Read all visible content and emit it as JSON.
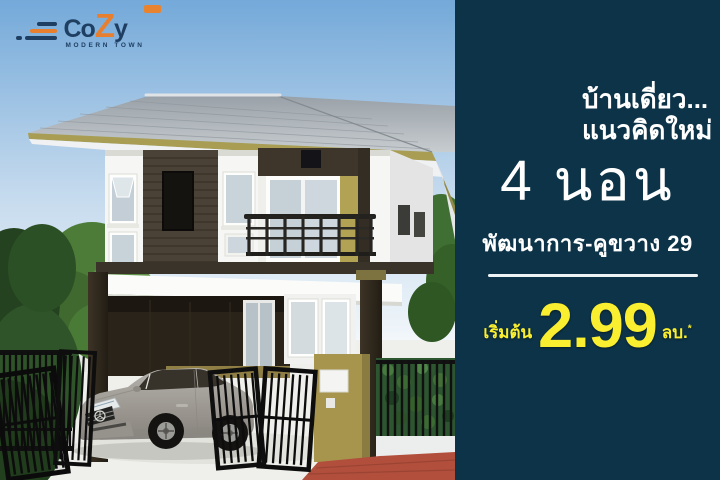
{
  "ad": {
    "logo": {
      "brand_co": "Co",
      "brand_z": "Z",
      "brand_y": "y",
      "tagline": "MODERN TOWN",
      "navy": "#1f3f62",
      "orange": "#e87f2f"
    },
    "panel": {
      "bg_color": "#0c3348",
      "headline_line1": "บ้านเดี่ยว...",
      "headline_line2": "แนวคิดใหม่",
      "bedrooms": "4 นอน",
      "location": "พัฒนาการ-คูขวาง 29",
      "price_prefix": "เริ่มต้น",
      "price_value": "2.99",
      "price_unit": "ลบ.",
      "price_footnote_mark": "*",
      "price_color": "#f9ee2f"
    },
    "scene": {
      "alt": "3D rendering of a modern two-storey detached house with grey hip roof, dark wood siding, balcony, carport with silver car, black fence and gates, green trees and hedge under a blue sky"
    }
  }
}
